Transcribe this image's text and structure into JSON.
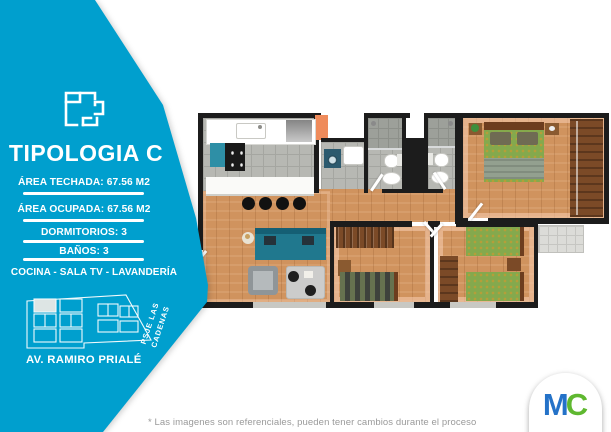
{
  "theme": {
    "accent": "#009fce",
    "wall": "#1c1c1c",
    "wood": "#d0935e",
    "tile": "#b7b8b3",
    "sofa_color": "#20788e",
    "bed_color": "#84a94d",
    "logo_m_color": "#2472c8",
    "logo_c_color": "#5fb830"
  },
  "sidebar": {
    "title": "TIPOLOGIA C",
    "specs": [
      {
        "label": "ÁREA TECHADA: 67.56 M2"
      },
      {
        "label": "ÁREA OCUPADA: 67.56 M2"
      },
      {
        "label": "DORMITORIOS: 3"
      },
      {
        "label": "BAÑOS: 3"
      },
      {
        "label": "COCINA - SALA TV - LAVANDERÍA"
      }
    ],
    "map": {
      "street": "AV. RAMIRO PRIALÉ",
      "passage": "PSJE LAS CADENAS"
    }
  },
  "footer": {
    "disclaimer": "* Las imagenes son referenciales, pueden tener cambios durante el proceso",
    "logo": {
      "m": "M",
      "c": "C"
    }
  }
}
